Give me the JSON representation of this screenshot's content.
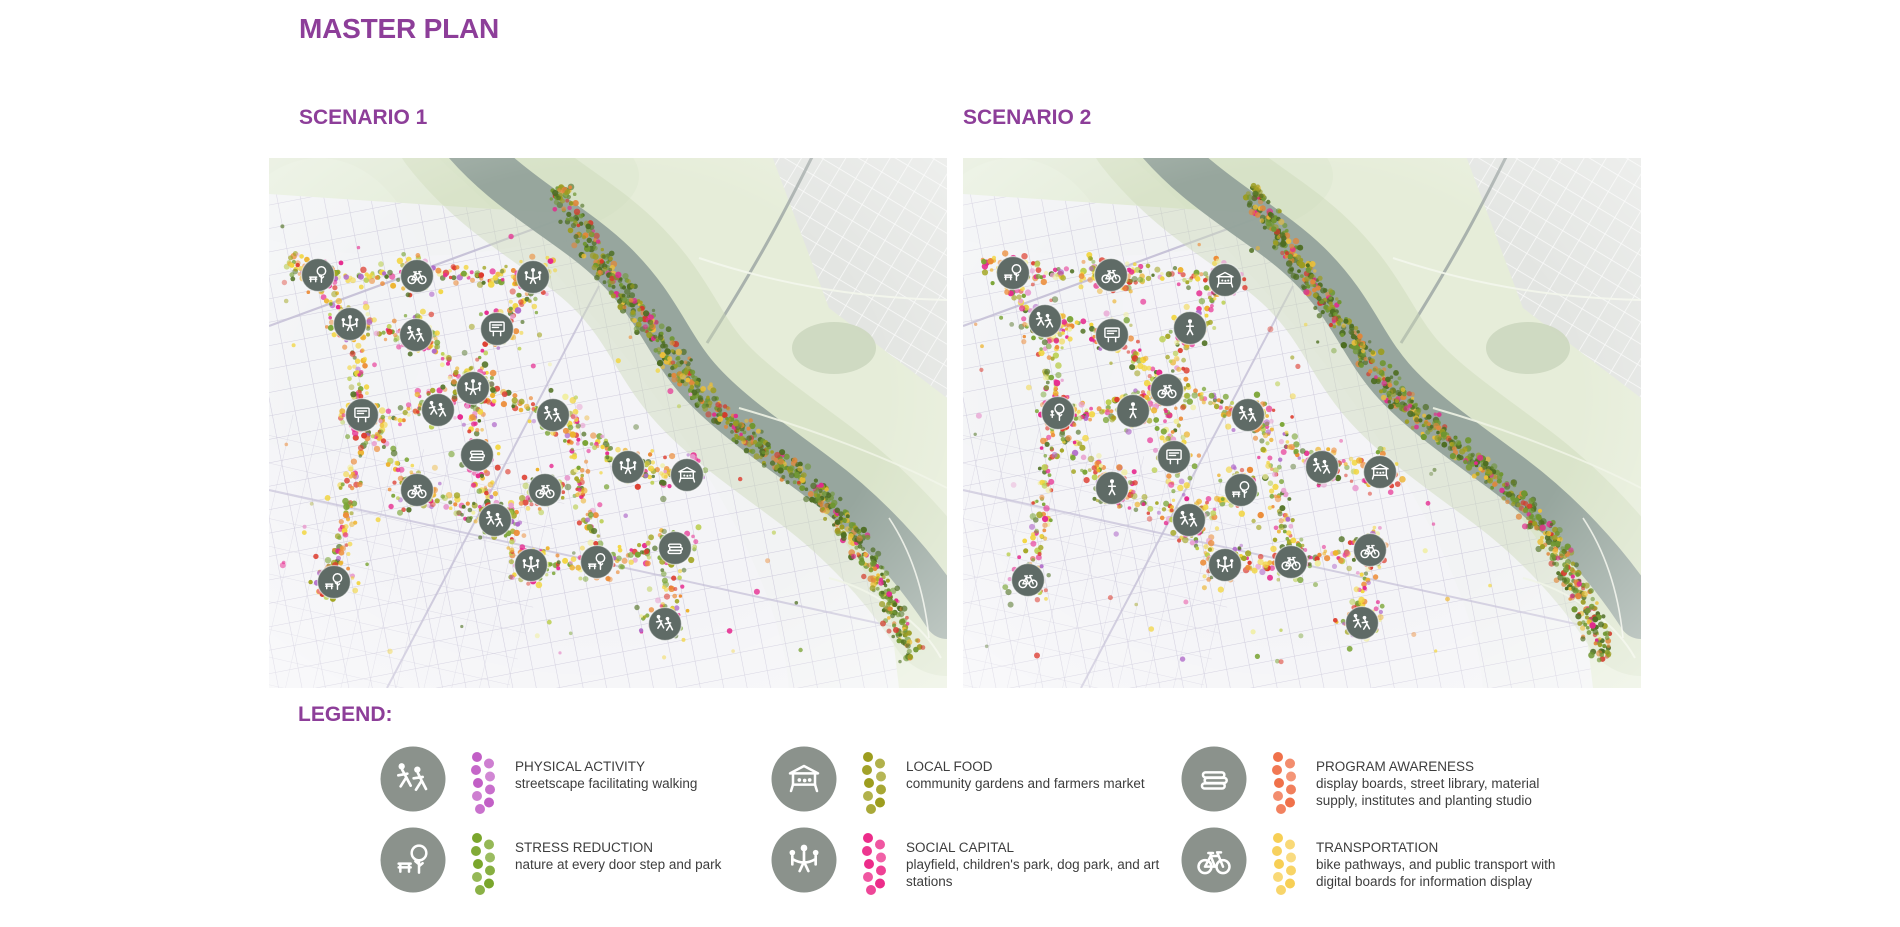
{
  "page": {
    "title": "MASTER PLAN"
  },
  "colors": {
    "accent": "#8d3e99",
    "text_dark": "#3d3d3d",
    "legend_icon_bg": "#8b928c",
    "map_icon_bg": "#5f6b66"
  },
  "scenarios": [
    {
      "label": "SCENARIO 1"
    },
    {
      "label": "SCENARIO 2"
    }
  ],
  "legend": {
    "heading": "LEGEND:",
    "items": [
      {
        "id": "physical-activity",
        "icon": "runner",
        "color": "#c25fc6",
        "title": "PHYSICAL ACTIVITY",
        "desc": "streetscape facilitating walking"
      },
      {
        "id": "stress-reduction",
        "icon": "tree-bench",
        "color": "#7aa62c",
        "title": "STRESS REDUCTION",
        "desc": "nature at every door step and park"
      },
      {
        "id": "local-food",
        "icon": "market",
        "color": "#9d9d1e",
        "title": "LOCAL FOOD",
        "desc": "community gardens and farmers market"
      },
      {
        "id": "social-capital",
        "icon": "people",
        "color": "#ec2c8a",
        "title": "SOCIAL CAPITAL",
        "desc": "playfield, children's park, dog park, and art stations"
      },
      {
        "id": "program-awareness",
        "icon": "books",
        "color": "#f0714a",
        "title": "PROGRAM AWARENESS",
        "desc": "display boards, street library, material supply, institutes and planting studio"
      },
      {
        "id": "transportation",
        "icon": "bike",
        "color": "#f7cf55",
        "title": "TRANSPORTATION",
        "desc": "bike pathways, and public transport with digital boards for information display"
      }
    ]
  },
  "map_render": {
    "palette_main": [
      [
        "#f2d53d",
        15
      ],
      [
        "#edb32e",
        8
      ],
      [
        "#ec8c38",
        12
      ],
      [
        "#dd3b2d",
        10
      ],
      [
        "#e62a8f",
        12
      ],
      [
        "#e89fd0",
        5
      ],
      [
        "#b06ac9",
        4
      ],
      [
        "#bccf52",
        7
      ],
      [
        "#7aa434",
        13
      ],
      [
        "#557529",
        10
      ],
      [
        "#a3a622",
        9
      ],
      [
        "#f0ee9e",
        3
      ]
    ],
    "palette_bank": [
      [
        "#4d6d22",
        30
      ],
      [
        "#6f9631",
        26
      ],
      [
        "#9b9c22",
        16
      ],
      [
        "#e0873a",
        10
      ],
      [
        "#d23b2b",
        5
      ],
      [
        "#e02a8c",
        6
      ],
      [
        "#edbf37",
        7
      ]
    ],
    "corridors": [
      [
        [
          18,
          103
        ],
        [
          49,
          117
        ],
        [
          105,
          118
        ],
        [
          160,
          118
        ],
        [
          212,
          118
        ],
        [
          264,
          119
        ]
      ],
      [
        [
          49,
          117
        ],
        [
          68,
          150
        ],
        [
          81,
          166
        ],
        [
          90,
          212
        ],
        [
          93,
          257
        ],
        [
          83,
          330
        ],
        [
          72,
          382
        ],
        [
          65,
          424
        ]
      ],
      [
        [
          81,
          166
        ],
        [
          118,
          172
        ],
        [
          147,
          177
        ],
        [
          176,
          202
        ],
        [
          204,
          230
        ]
      ],
      [
        [
          264,
          119
        ],
        [
          246,
          148
        ],
        [
          228,
          171
        ],
        [
          215,
          202
        ],
        [
          204,
          230
        ]
      ],
      [
        [
          204,
          230
        ],
        [
          188,
          242
        ],
        [
          169,
          252
        ],
        [
          132,
          256
        ],
        [
          93,
          257
        ]
      ],
      [
        [
          204,
          230
        ],
        [
          244,
          244
        ],
        [
          284,
          257
        ],
        [
          322,
          283
        ],
        [
          359,
          309
        ],
        [
          390,
          314
        ],
        [
          418,
          317
        ]
      ],
      [
        [
          204,
          230
        ],
        [
          206,
          264
        ],
        [
          208,
          297
        ],
        [
          217,
          331
        ],
        [
          226,
          362
        ]
      ],
      [
        [
          148,
          332
        ],
        [
          186,
          348
        ],
        [
          226,
          362
        ],
        [
          244,
          386
        ],
        [
          262,
          407
        ],
        [
          296,
          408
        ],
        [
          328,
          404
        ],
        [
          368,
          397
        ],
        [
          406,
          390
        ]
      ],
      [
        [
          406,
          390
        ],
        [
          401,
          428
        ],
        [
          396,
          466
        ]
      ],
      [
        [
          93,
          257
        ],
        [
          119,
          295
        ],
        [
          148,
          332
        ]
      ],
      [
        [
          276,
          332
        ],
        [
          252,
          348
        ],
        [
          226,
          362
        ]
      ],
      [
        [
          284,
          257
        ],
        [
          306,
          296
        ],
        [
          318,
          350
        ],
        [
          328,
          404
        ]
      ]
    ],
    "bank": [
      [
        288,
        28
      ],
      [
        310,
        68
      ],
      [
        338,
        112
      ],
      [
        372,
        158
      ],
      [
        408,
        204
      ],
      [
        444,
        248
      ],
      [
        488,
        286
      ],
      [
        538,
        324
      ],
      [
        578,
        368
      ],
      [
        608,
        418
      ],
      [
        628,
        462
      ],
      [
        643,
        500
      ]
    ],
    "maps": [
      {
        "id": "m0",
        "name": "scenario-1-map",
        "seed": 7,
        "icons": [
          [
            "tree-bench",
            49,
            117
          ],
          [
            "bike",
            148,
            118
          ],
          [
            "people",
            264,
            119
          ],
          [
            "people",
            81,
            166
          ],
          [
            "runner",
            147,
            177
          ],
          [
            "board",
            228,
            171
          ],
          [
            "people",
            204,
            230
          ],
          [
            "runner",
            169,
            252
          ],
          [
            "board",
            93,
            257
          ],
          [
            "runner",
            284,
            257
          ],
          [
            "books",
            208,
            297
          ],
          [
            "people",
            359,
            309
          ],
          [
            "market",
            418,
            317
          ],
          [
            "bike",
            148,
            332
          ],
          [
            "bike",
            276,
            332
          ],
          [
            "runner",
            226,
            362
          ],
          [
            "people",
            262,
            407
          ],
          [
            "tree-bench",
            328,
            404
          ],
          [
            "books",
            406,
            390
          ],
          [
            "tree-bench",
            65,
            424
          ],
          [
            "runner",
            396,
            466
          ]
        ]
      },
      {
        "id": "m1",
        "name": "scenario-2-map",
        "seed": 13,
        "icons": [
          [
            "tree-bench",
            50,
            115
          ],
          [
            "bike",
            148,
            117
          ],
          [
            "market",
            262,
            122
          ],
          [
            "runner",
            82,
            163
          ],
          [
            "board",
            149,
            177
          ],
          [
            "person",
            227,
            170
          ],
          [
            "bike",
            204,
            232
          ],
          [
            "person",
            170,
            253
          ],
          [
            "tree",
            95,
            255
          ],
          [
            "runner",
            285,
            257
          ],
          [
            "board",
            211,
            299
          ],
          [
            "person",
            149,
            330
          ],
          [
            "tree-bench",
            278,
            332
          ],
          [
            "runner",
            359,
            309
          ],
          [
            "market",
            417,
            314
          ],
          [
            "runner",
            226,
            362
          ],
          [
            "people",
            262,
            407
          ],
          [
            "bike",
            328,
            404
          ],
          [
            "bike",
            407,
            392
          ],
          [
            "bike",
            65,
            422
          ],
          [
            "runner",
            399,
            465
          ]
        ]
      }
    ]
  }
}
